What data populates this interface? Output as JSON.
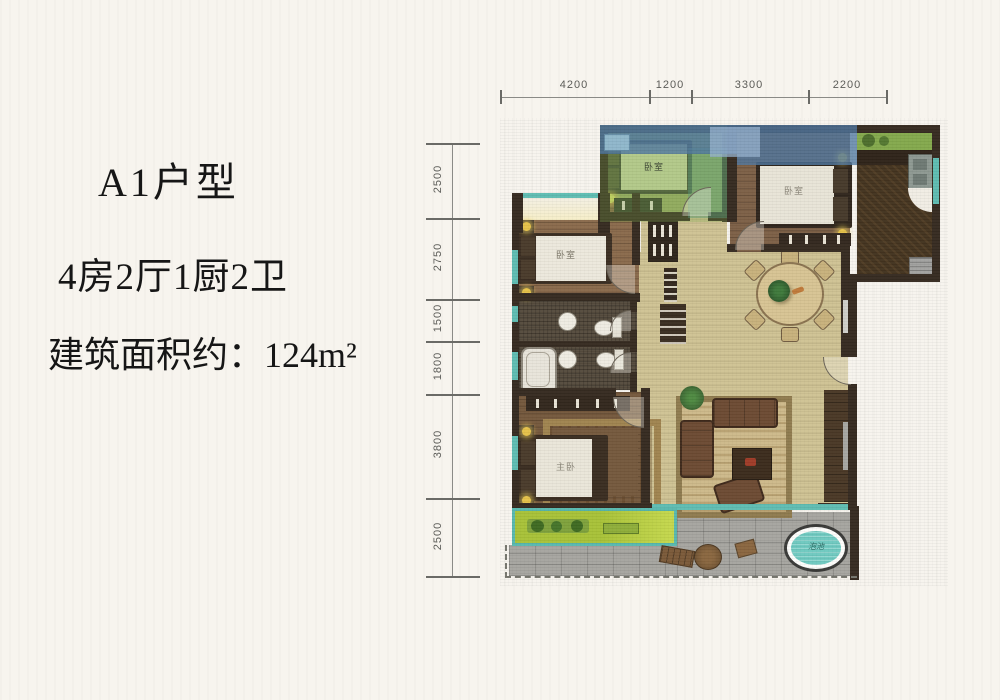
{
  "info": {
    "title": "A1户型",
    "layout": "4房2厅1厨2卫",
    "area": "建筑面积约：124m²"
  },
  "dims": {
    "top": [
      "4200",
      "1200",
      "3300",
      "2200"
    ],
    "left": [
      "2500",
      "2750",
      "1500",
      "1800",
      "3800",
      "2500"
    ]
  },
  "rooms": {
    "bedroom_top": "卧室",
    "bedroom_right": "卧室",
    "bedroom_left": "卧室",
    "bedroom_master": "主卧",
    "hot_tub": "泡池"
  },
  "colors": {
    "paper": "#f7f4ee",
    "wall": "#362b21",
    "tan_floor": "#cfc394",
    "wood_floor": "#7d6047",
    "green_room": "#9cb169",
    "blue_overlay": "#5d87b0",
    "balcony_green": "#b3c93e",
    "terrace_gray": "#a6a5a0",
    "window_teal": "#5fbdb2",
    "hot_tub_teal": "#6fc9c0",
    "lamp_yellow": "#e5c24a"
  }
}
